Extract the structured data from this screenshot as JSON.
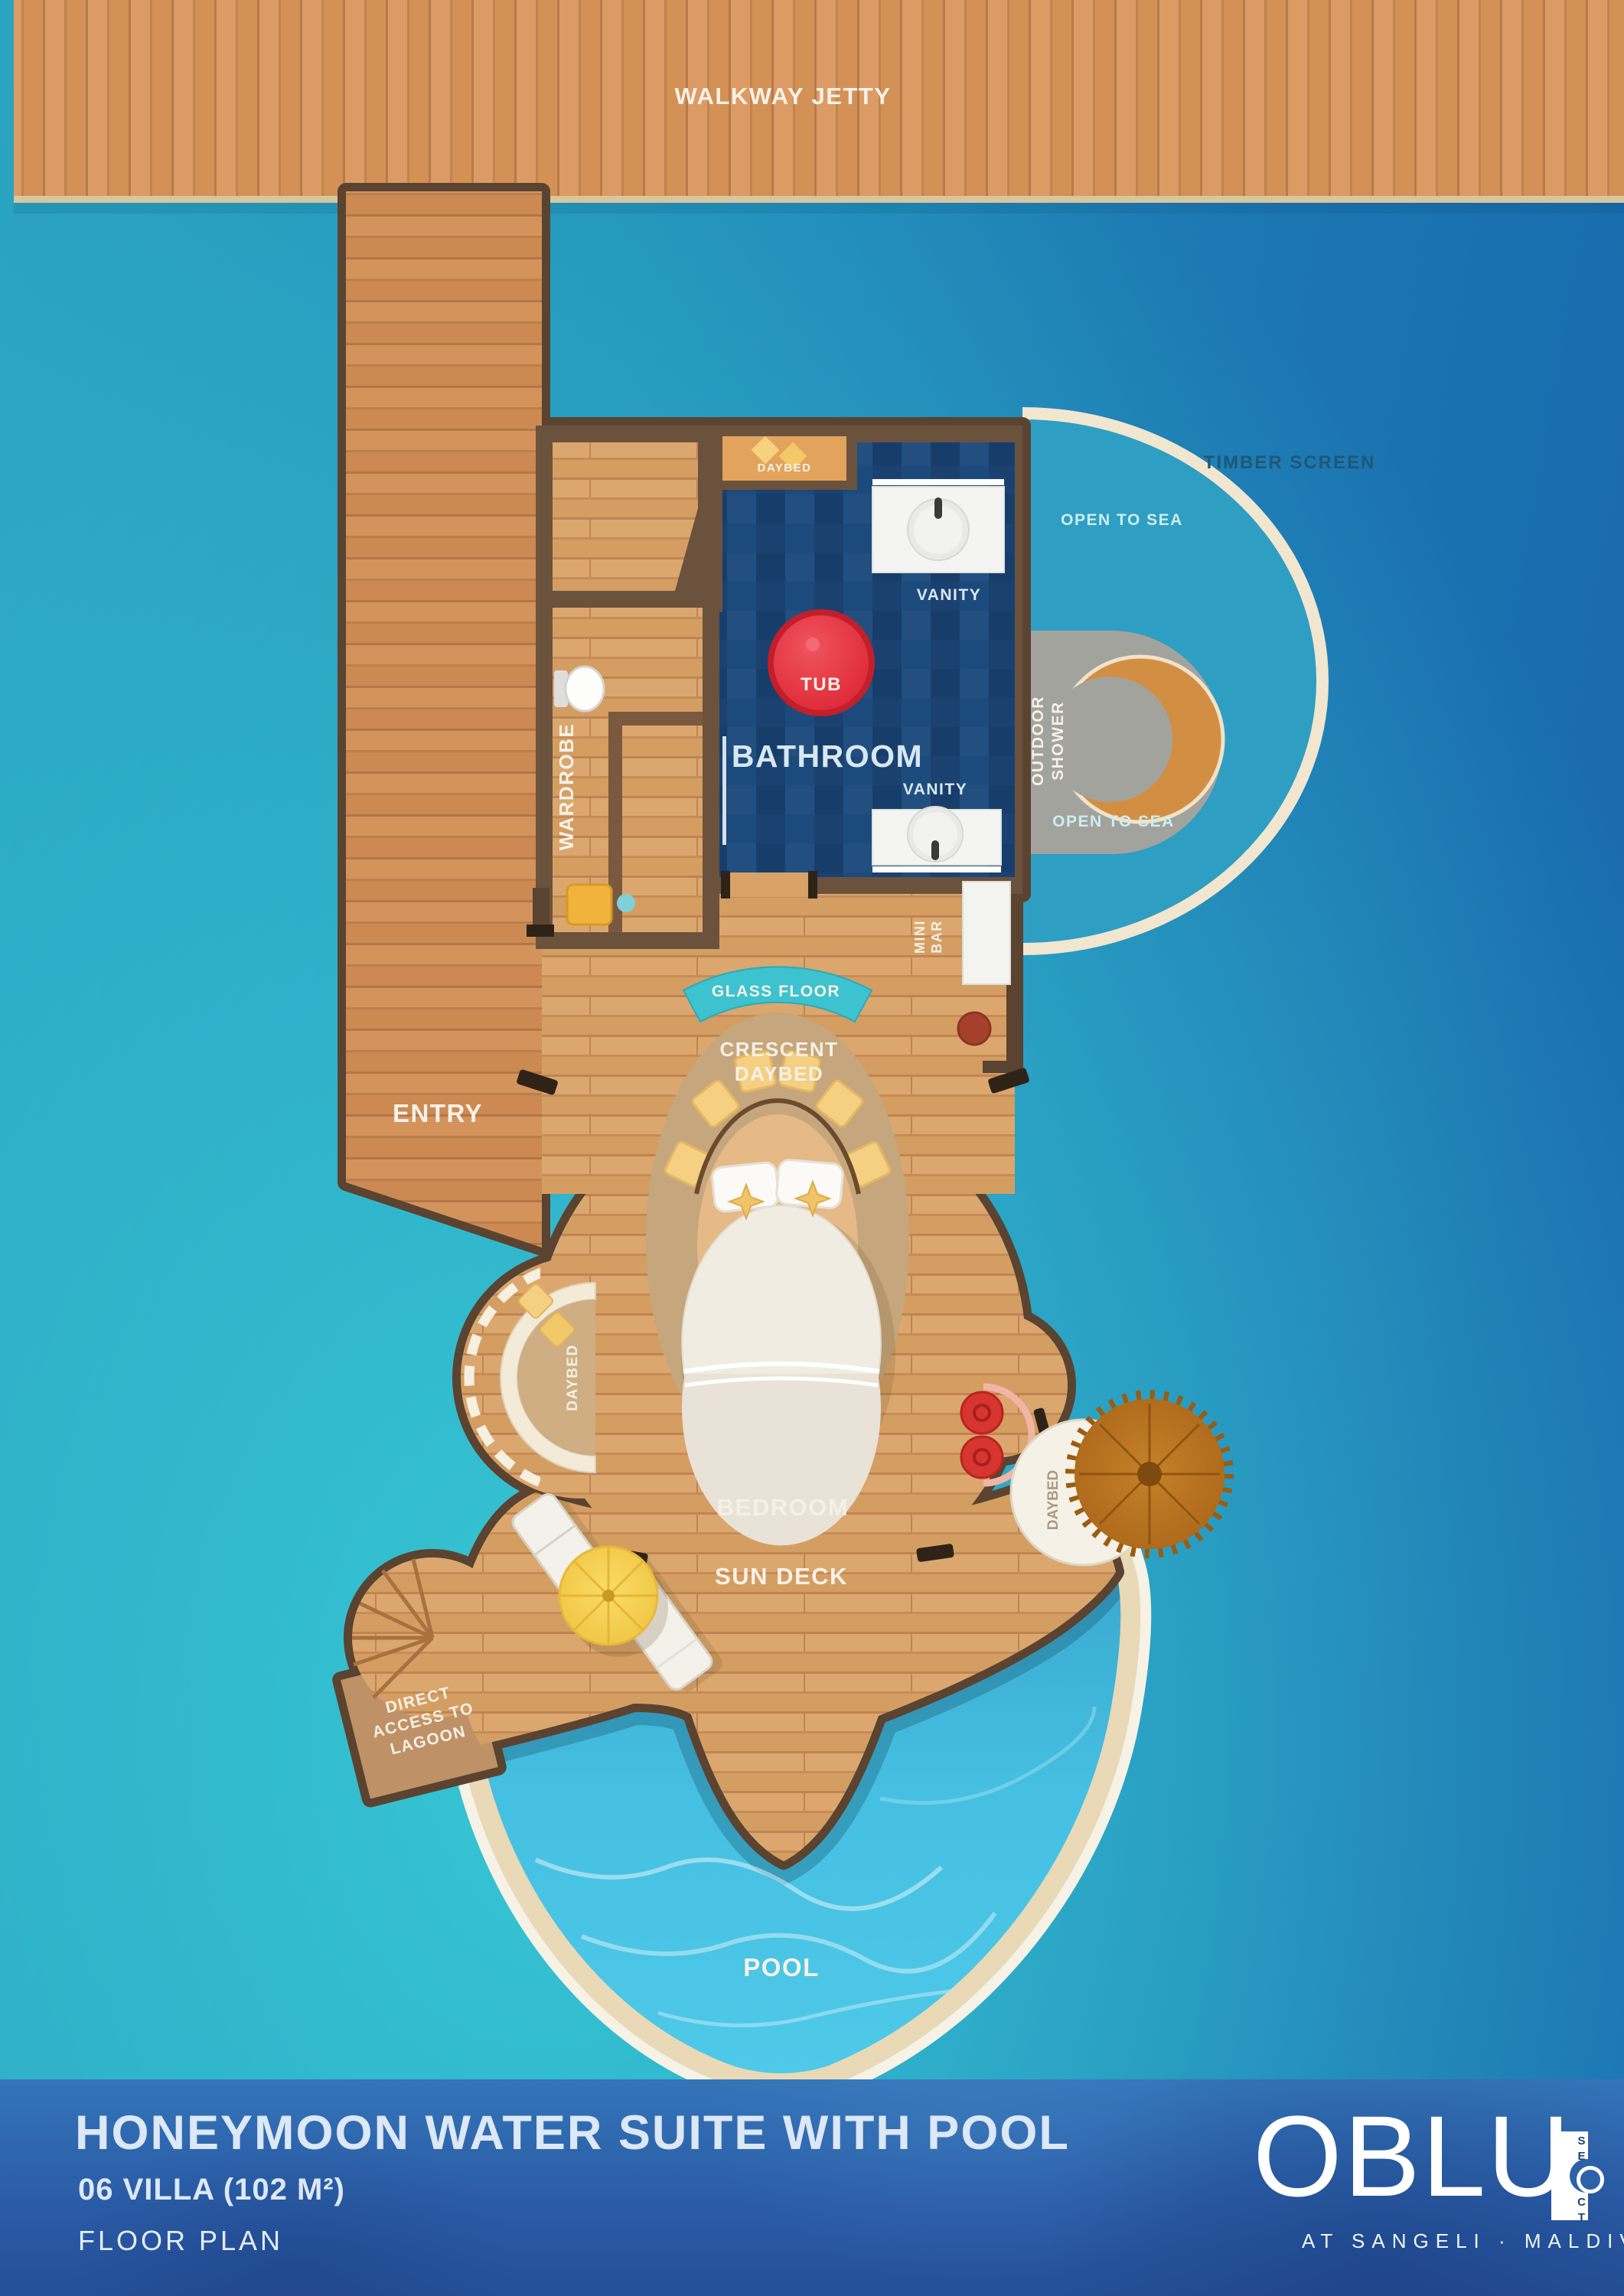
{
  "plan": {
    "walkway_jetty": "WALKWAY JETTY",
    "entry": "ENTRY",
    "wardrobe": "WARDROBE",
    "bath_daybed": "DAYBED",
    "vanity_top": "VANITY",
    "vanity_bottom": "VANITY",
    "tub": "TUB",
    "bathroom": "BATHROOM",
    "outdoor_shower": [
      "OUTDOOR",
      "SHOWER"
    ],
    "timber_screen": "TIMBER SCREEN",
    "open_to_sea_top": "OPEN TO SEA",
    "open_to_sea_bottom": "OPEN TO SEA",
    "mini_bar": [
      "MINI",
      "BAR"
    ],
    "glass_floor": "GLASS FLOOR",
    "crescent_daybed": [
      "CRESCENT",
      "DAYBED"
    ],
    "bedroom": "BEDROOM",
    "daybed_west": "DAYBED",
    "daybed_hanging": "DAYBED",
    "sun_deck": "SUN DECK",
    "pool": "POOL",
    "direct_access": [
      "DIRECT",
      "ACCESS TO",
      "LAGOON"
    ]
  },
  "footer": {
    "title": "HONEYMOON WATER SUITE WITH POOL",
    "villa": "06 VILLA (102 M²)",
    "floor_plan": "FLOOR PLAN",
    "brand": "OBLU",
    "brand_select": "SELECT",
    "brand_location": "AT SANGELI · MALDIVES"
  },
  "colors": {
    "ocean_teal": "#38cbd6",
    "ocean_deep": "#1a6cae",
    "wood": "#d9a368",
    "wall": "#5a4330",
    "tile": "#1d4a7c",
    "tub_red": "#e62e38",
    "pool_water": "#45c2de",
    "sand": "#ead9b6",
    "cream": "#f2e8d4",
    "panel_blue": "#2d64ab"
  }
}
